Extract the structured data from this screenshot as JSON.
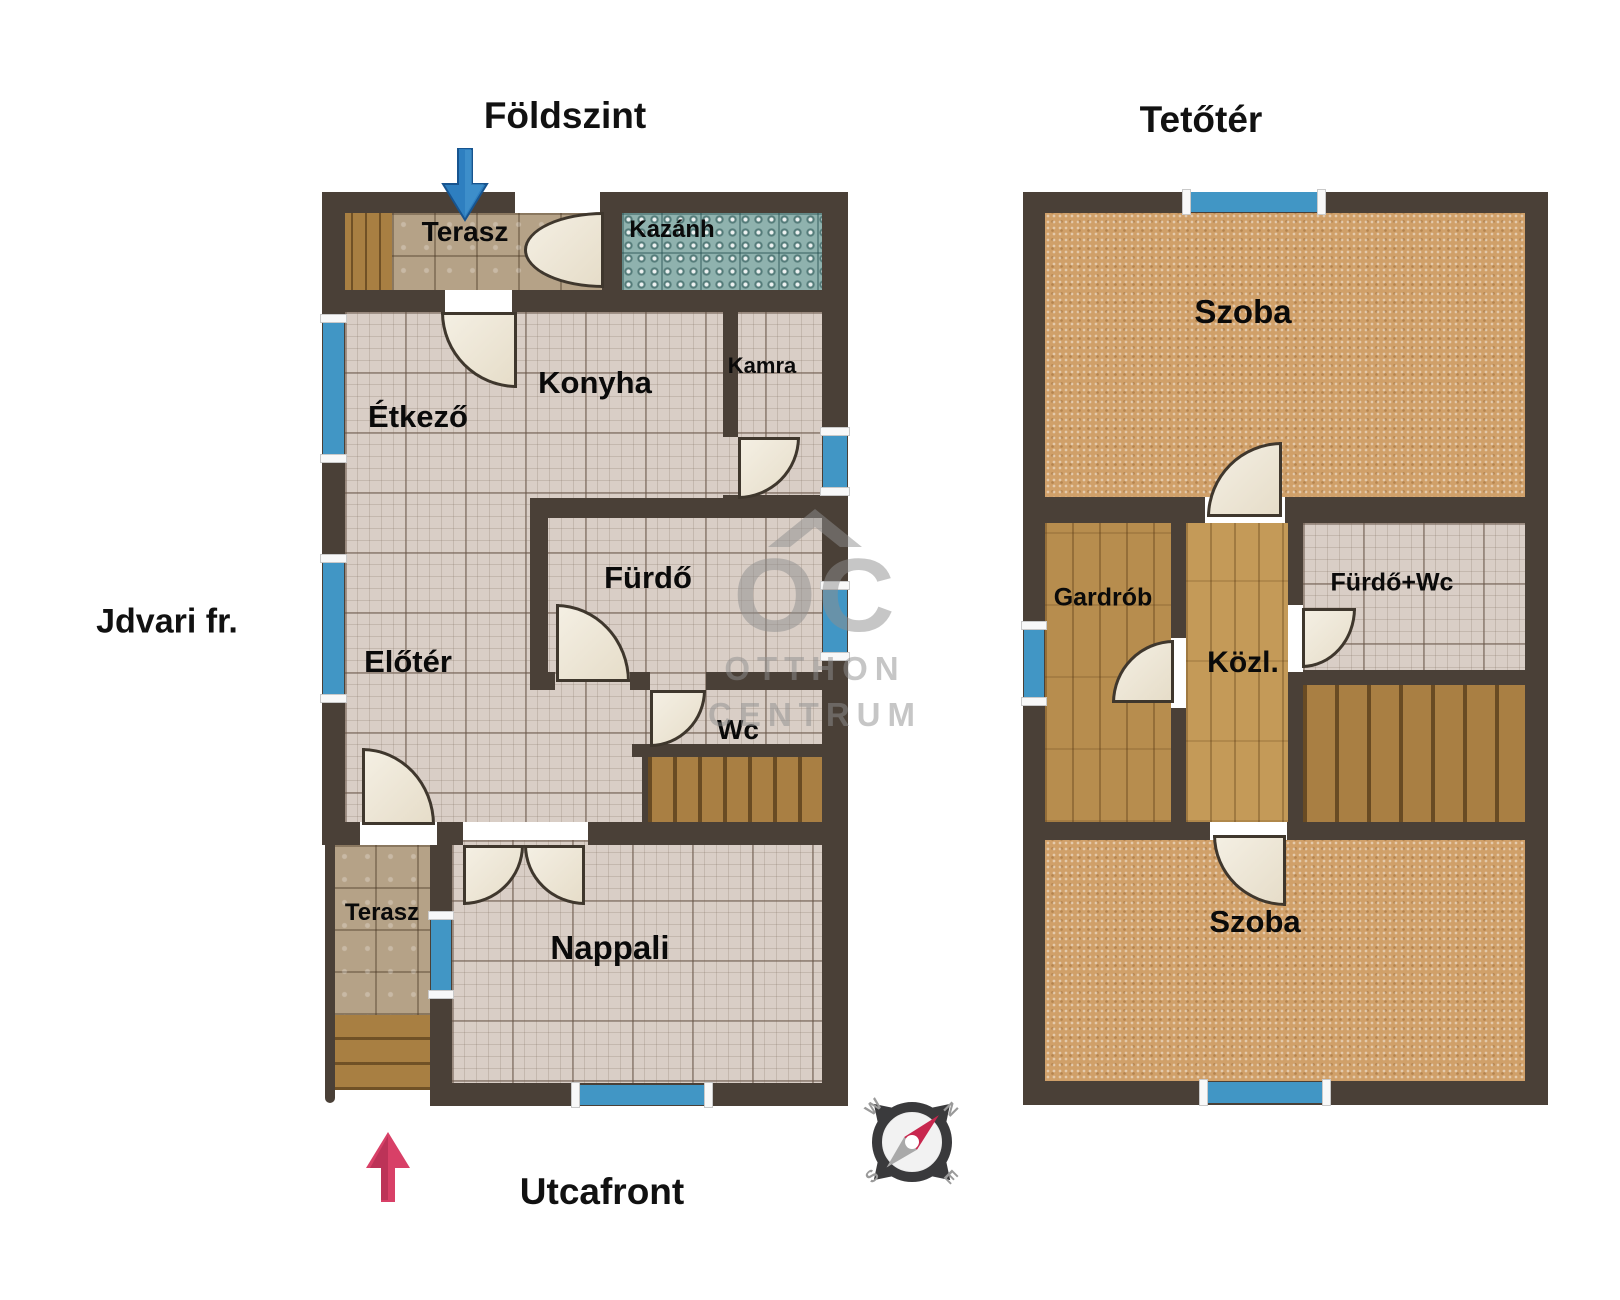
{
  "ground": {
    "title": "Földszint",
    "rooms": {
      "terasz_top": "Terasz",
      "kazanh": "Kazánh",
      "etkezo": "Étkező",
      "konyha": "Konyha",
      "kamra": "Kamra",
      "furdo": "Fürdő",
      "eloter": "Előtér",
      "wc": "Wc",
      "nappali": "Nappali",
      "terasz_bottom": "Terasz"
    }
  },
  "attic": {
    "title": "Tetőtér",
    "rooms": {
      "szoba_top": "Szoba",
      "gardrob": "Gardrób",
      "kozl": "Közl.",
      "furdo_wc": "Fürdő+Wc",
      "szoba_bottom": "Szoba"
    }
  },
  "annotations": {
    "courtyard_front": "Jdvari fr.",
    "street_front": "Utcafront"
  },
  "compass": {
    "n": "N",
    "e": "E",
    "s": "S",
    "w": "W"
  },
  "watermark": {
    "logo": "OC",
    "line1": "OTTHON",
    "line2": "CENTRUM"
  },
  "colors": {
    "wall": "#4a4037",
    "window_blue": "#4196c5",
    "tile_floor": "#d9cec6",
    "terrace_tile": "#b5a287",
    "boiler_tile": "#8fb2ae",
    "wood": "#a87f42",
    "carpet": "#d0a069",
    "door_leaf": "#f0e9db",
    "entrance_arrow_blue": "#2e7fc0",
    "street_arrow_red": "#d84067",
    "watermark_gray": "#8f8f8f"
  }
}
